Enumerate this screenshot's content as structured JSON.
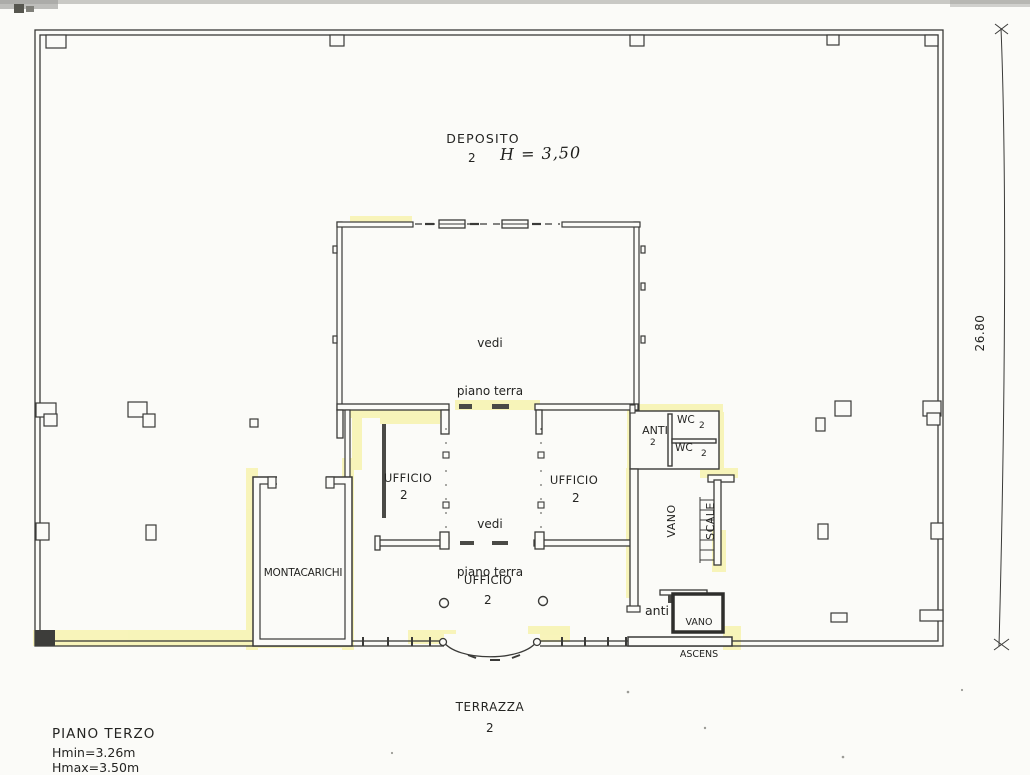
{
  "rooms": {
    "deposito": {
      "label": "DEPOSITO",
      "number": "2",
      "height_note": "H = 3,50"
    },
    "hall_upper": {
      "line1": "vedi",
      "line2": "piano terra"
    },
    "ufficio_left": {
      "label": "UFFICIO",
      "number": "2"
    },
    "hall_lower": {
      "line1": "vedi",
      "line2": "piano terra"
    },
    "ufficio_right": {
      "label": "UFFICIO",
      "number": "2"
    },
    "ufficio_bottom": {
      "label": "UFFICIO",
      "number": "2"
    },
    "montacarichi": {
      "label": "MONTACARICHI"
    },
    "anti": {
      "label": "ANTI",
      "number": "2"
    },
    "wc_top": {
      "label": "WC",
      "number": "2"
    },
    "wc_bottom": {
      "label": "WC",
      "number": "2"
    },
    "vano_scale": {
      "line1": "VANO",
      "line2": "SCALE"
    },
    "anti_small": {
      "label": "anti"
    },
    "vano_ascens": {
      "line1": "VANO",
      "line2": "ASCENS"
    },
    "terrazza": {
      "label": "TERRAZZA",
      "number": "2"
    }
  },
  "dimensions": {
    "right_total": "26.80"
  },
  "title_block": {
    "floor": "PIANO TERZO",
    "hmin": "Hmin=3.26m",
    "hmax": "Hmax=3.50m"
  },
  "colors": {
    "ink": "#3a3a38",
    "highlight": "#f5ee7c",
    "paper": "#fbfbf8"
  }
}
